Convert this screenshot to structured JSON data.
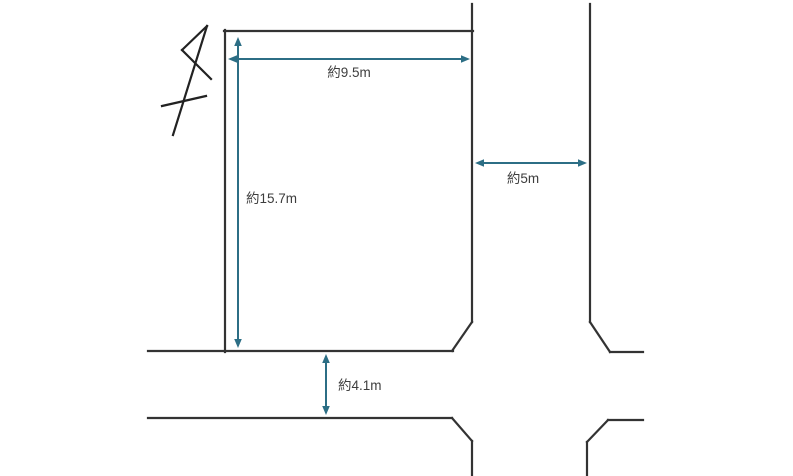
{
  "diagram": {
    "type": "land-plot-site-plan",
    "canvas": {
      "width": 793,
      "height": 476,
      "background": "#ffffff"
    },
    "colors": {
      "outline": "#333333",
      "north_arrow": "#222222",
      "dimension": "#2c6e85",
      "label_text": "#3d3d3d"
    },
    "north_arrow": {
      "name": "north-arrow",
      "segments": [
        [
          173,
          135,
          207,
          26
        ],
        [
          207,
          26,
          182,
          50
        ],
        [
          182,
          50,
          211,
          79
        ],
        [
          162,
          106,
          206,
          96
        ]
      ]
    },
    "outline_segments": [
      [
        225,
        30,
        225,
        352
      ],
      [
        224,
        31,
        473,
        31
      ],
      [
        472,
        4,
        472,
        322
      ],
      [
        472,
        322,
        452,
        351
      ],
      [
        148,
        351,
        453,
        351
      ],
      [
        590,
        4,
        590,
        322
      ],
      [
        590,
        322,
        610,
        352
      ],
      [
        610,
        352,
        643,
        352
      ],
      [
        148,
        418,
        452,
        418
      ],
      [
        452,
        418,
        472,
        441
      ],
      [
        472,
        441,
        472,
        476
      ],
      [
        587,
        476,
        587,
        442
      ],
      [
        587,
        442,
        608,
        420
      ],
      [
        608,
        420,
        643,
        420
      ]
    ],
    "dimensions": [
      {
        "id": "lot-width",
        "label": "約9.5m",
        "x1": 228,
        "y1": 59,
        "x2": 470,
        "y2": 59,
        "label_x": 349,
        "label_y": 77,
        "anchor": "middle"
      },
      {
        "id": "lot-depth",
        "label": "約15.7m",
        "x1": 238,
        "y1": 37,
        "x2": 238,
        "y2": 348,
        "label_x": 246,
        "label_y": 203,
        "anchor": "start"
      },
      {
        "id": "east-road",
        "label": "約5m",
        "x1": 475,
        "y1": 163,
        "x2": 587,
        "y2": 163,
        "label_x": 523,
        "label_y": 183,
        "anchor": "middle"
      },
      {
        "id": "south-road",
        "label": "約4.1m",
        "x1": 326,
        "y1": 354,
        "x2": 326,
        "y2": 415,
        "label_x": 338,
        "label_y": 390,
        "anchor": "start"
      }
    ]
  }
}
